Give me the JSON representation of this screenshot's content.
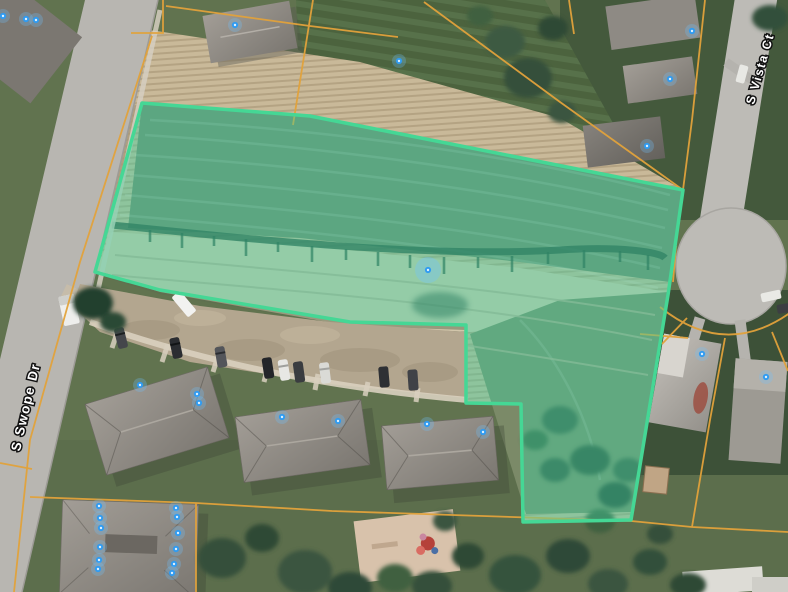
{
  "map": {
    "street_labels": [
      {
        "text": "S Swope Dr"
      },
      {
        "text": "S Vista Ct"
      }
    ],
    "colors": {
      "highlight_fill": "#3ed3a1",
      "highlight_border": "#45d795",
      "parcel_line": "#e2a23b",
      "marker": "#2f9bf2",
      "marker_halo": "#6fc2ff"
    },
    "highlight_parcel": {
      "points": "142,103 310,116 683,190 668,295 631,520 523,522 521,404 466,403 466,325 350,322 160,290 95,272"
    },
    "markers": {
      "points": [
        [
          3,
          16
        ],
        [
          26,
          19
        ],
        [
          36,
          20
        ],
        [
          235,
          25
        ],
        [
          399,
          61
        ],
        [
          692,
          31
        ],
        [
          670,
          79
        ],
        [
          647,
          146
        ],
        [
          428,
          270,
          2
        ],
        [
          702,
          354
        ],
        [
          766,
          377
        ],
        [
          140,
          385
        ],
        [
          197,
          394
        ],
        [
          199,
          403
        ],
        [
          282,
          417
        ],
        [
          338,
          421
        ],
        [
          427,
          424
        ],
        [
          483,
          432
        ],
        [
          99,
          506
        ],
        [
          100,
          518
        ],
        [
          101,
          528
        ],
        [
          100,
          547
        ],
        [
          99,
          560
        ],
        [
          98,
          569
        ],
        [
          176,
          508
        ],
        [
          177,
          517
        ],
        [
          178,
          533
        ],
        [
          176,
          549
        ],
        [
          174,
          564
        ],
        [
          172,
          573
        ]
      ]
    }
  }
}
